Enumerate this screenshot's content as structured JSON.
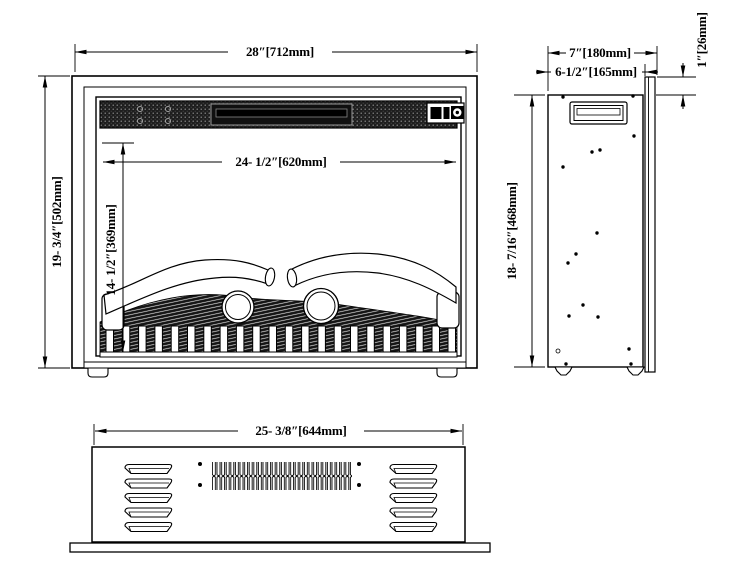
{
  "drawing": {
    "type": "technical-dimension-drawing",
    "subject": "electric-fireplace-insert",
    "colors": {
      "line": "#000000",
      "background": "#ffffff"
    },
    "front_view": {
      "width_label": "28″[712mm]",
      "height_label": "19- 3/4″[502mm]",
      "opening_width_label": "24- 1/2″[620mm]",
      "opening_height_label": "14- 1/2″[369mm]"
    },
    "side_view": {
      "depth_label": "7″[180mm]",
      "body_depth_label": "6-1/2″[165mm]",
      "flange_offset_label": "1″[26mm]",
      "height_label": "18- 7/16″[468mm]"
    },
    "bottom_view": {
      "width_label": "25- 3/8″[644mm]"
    }
  }
}
